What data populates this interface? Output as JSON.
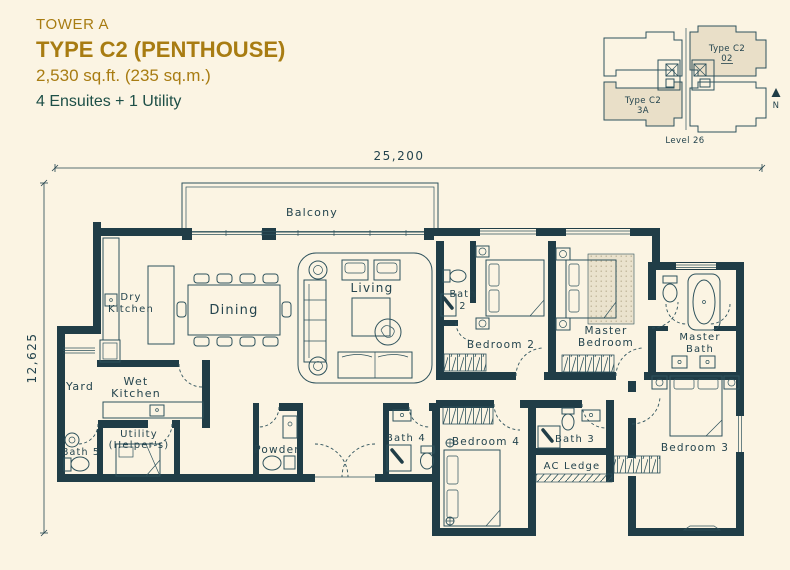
{
  "colors": {
    "background": "#fbf4e3",
    "wall": "#203d47",
    "line": "#2e525c",
    "gold": "#a87c12",
    "teal_text": "#1d4f47",
    "label": "#24444e",
    "keyplan_fill": "#e9dfc8",
    "rug": "#eae2cd"
  },
  "title_block": {
    "tower": "TOWER A",
    "unit_type": "TYPE C2 (PENTHOUSE)",
    "area": "2,530 sq.ft. (235 sq.m.)",
    "config": "4 Ensuites + 1 Utility"
  },
  "keyplan": {
    "unit_top": {
      "line1": "Type C2",
      "line2": "02"
    },
    "unit_bottom": {
      "line1": "Type C2",
      "line2": "3A"
    },
    "level": "Level 26",
    "north_label": "N"
  },
  "dimensions": {
    "top": "25,200",
    "left": "12,625"
  },
  "rooms": {
    "balcony": [
      "Balcony"
    ],
    "dry_kitchen": [
      "Dry",
      "Kitchen"
    ],
    "dining": [
      "Dining"
    ],
    "living": [
      "Living"
    ],
    "yard": [
      "Yard"
    ],
    "wet_kitchen": [
      "Wet",
      "Kitchen"
    ],
    "bath5": [
      "Bath 5"
    ],
    "utility": [
      "Utility",
      "(Helper's)"
    ],
    "powder": [
      "Powder"
    ],
    "bath4": [
      "Bath 4"
    ],
    "bedroom4": [
      "Bedroom 4"
    ],
    "bath2": [
      "Bath",
      "2"
    ],
    "bedroom2": [
      "Bedroom 2"
    ],
    "master_bedroom": [
      "Master",
      "Bedroom"
    ],
    "master_bath": [
      "Master",
      "Bath"
    ],
    "bath3": [
      "Bath 3"
    ],
    "ac_ledge": [
      "AC Ledge"
    ],
    "bedroom3": [
      "Bedroom 3"
    ]
  }
}
